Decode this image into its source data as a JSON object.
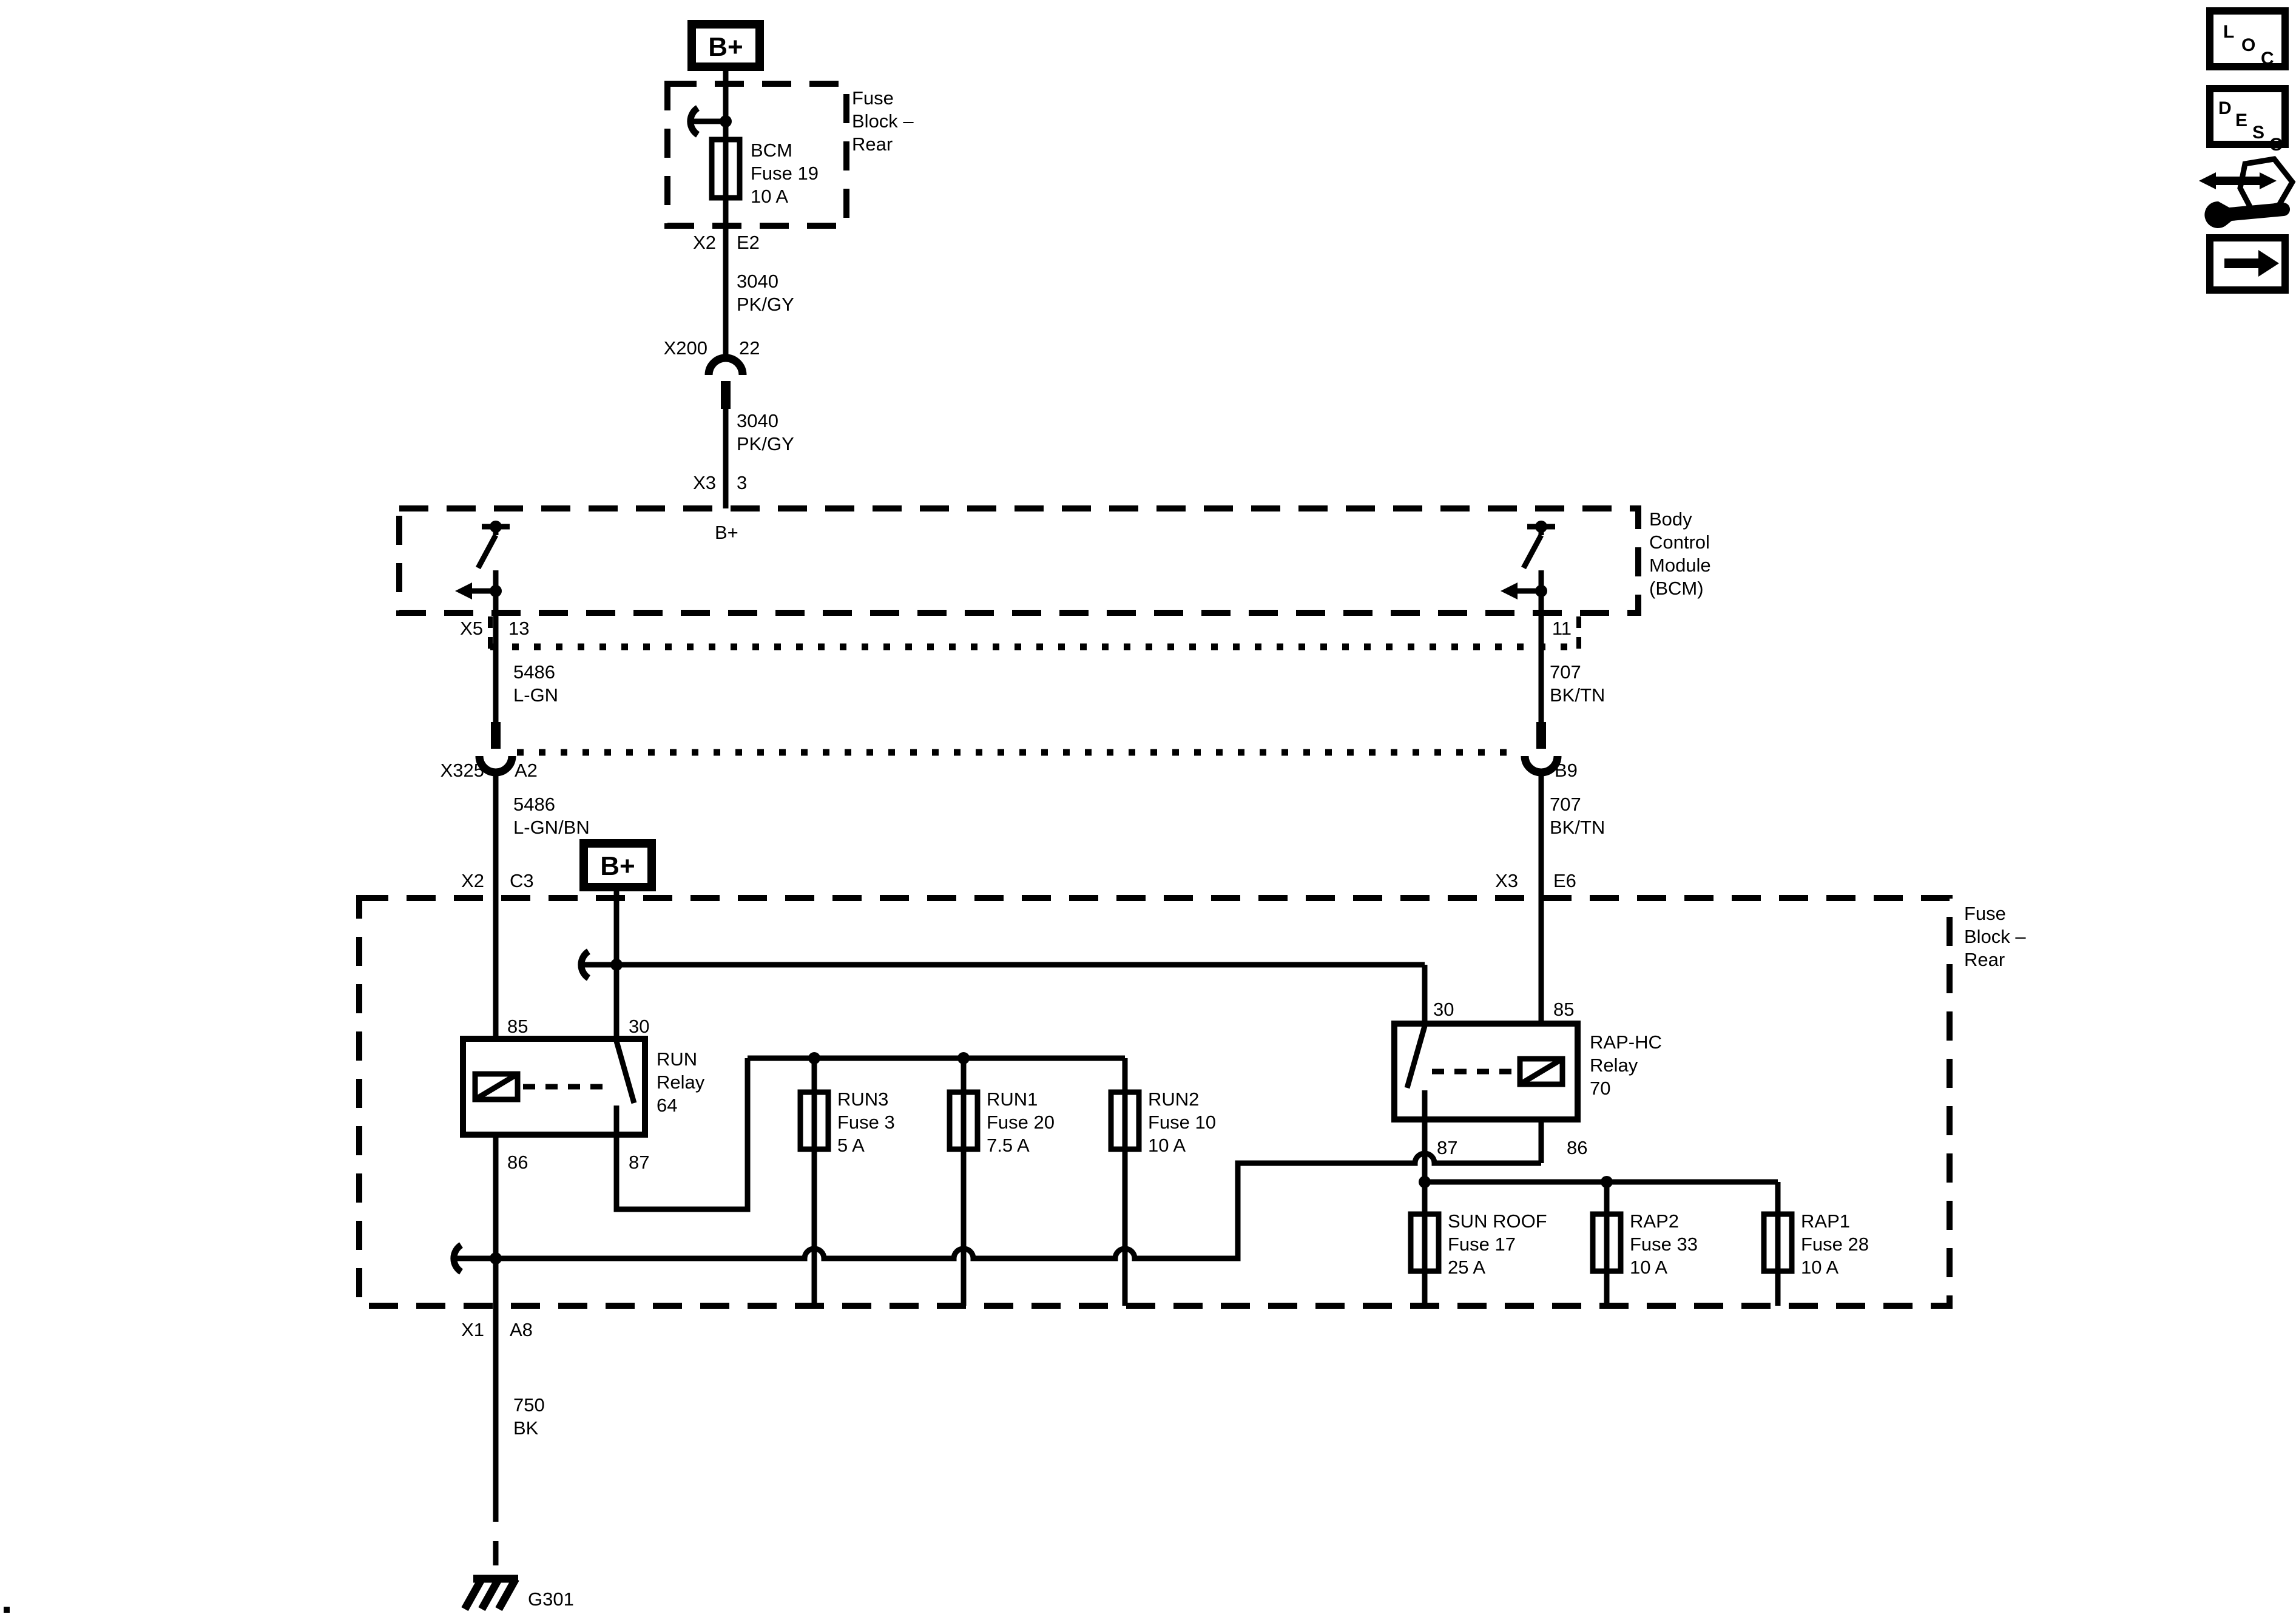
{
  "colors": {
    "ink": "#000000",
    "paper": "#ffffff"
  },
  "top_feed": {
    "battery_symbol": "B+",
    "conn_x2": {
      "name": "X2",
      "pin": "E2"
    },
    "wire_a": {
      "circuit": "3040",
      "color": "PK/GY"
    },
    "splice": {
      "name": "X200",
      "pin": "22"
    },
    "wire_b": {
      "circuit": "3040",
      "color": "PK/GY"
    },
    "conn_x3": {
      "name": "X3",
      "pin": "3"
    }
  },
  "top_fuse_block": {
    "label": [
      "Fuse",
      "Block –",
      "Rear"
    ],
    "fuse": [
      "BCM",
      "Fuse 19",
      "10 A"
    ]
  },
  "bcm": {
    "label": [
      "Body",
      "Control",
      "Module",
      "(BCM)"
    ],
    "b_plus": "B+",
    "left_out": {
      "conn": "X5",
      "pin": "13"
    },
    "right_out": {
      "pin": "11"
    }
  },
  "harness": {
    "left_wire_1": {
      "circuit": "5486",
      "color": "L-GN"
    },
    "right_wire_1": {
      "circuit": "707",
      "color": "BK/TN"
    },
    "conn_row": {
      "name": "X325",
      "left_pin": "A2",
      "right_pin": "B9"
    },
    "left_wire_2": {
      "circuit": "5486",
      "color": "L-GN/BN"
    },
    "right_wire_2": {
      "circuit": "707",
      "color": "BK/TN"
    },
    "left_in": {
      "conn": "X2",
      "pin": "C3"
    },
    "right_in": {
      "conn": "X3",
      "pin": "E6"
    },
    "battery_symbol": "B+"
  },
  "rear_fuse_block": {
    "label": [
      "Fuse",
      "Block –",
      "Rear"
    ],
    "run_relay": {
      "label": [
        "RUN",
        "Relay",
        "64"
      ],
      "pin_tl": "85",
      "pin_tr": "30",
      "pin_bl": "86",
      "pin_br": "87"
    },
    "rap_relay": {
      "label": [
        "RAP-HC",
        "Relay",
        "70"
      ],
      "pin_tl": "30",
      "pin_tr": "85",
      "pin_bl": "87",
      "pin_br": "86"
    },
    "fuses": [
      {
        "lines": [
          "RUN3",
          "Fuse 3",
          "5 A"
        ]
      },
      {
        "lines": [
          "RUN1",
          "Fuse 20",
          "7.5 A"
        ]
      },
      {
        "lines": [
          "RUN2",
          "Fuse 10",
          "10 A"
        ]
      },
      {
        "lines": [
          "SUN ROOF",
          "Fuse 17",
          "25 A"
        ]
      },
      {
        "lines": [
          "RAP2",
          "Fuse 33",
          "10 A"
        ]
      },
      {
        "lines": [
          "RAP1",
          "Fuse 28",
          "10 A"
        ]
      }
    ]
  },
  "ground_path": {
    "out": {
      "conn": "X1",
      "pin": "A8"
    },
    "wire": {
      "circuit": "750",
      "color": "BK"
    },
    "ground": "G301"
  },
  "nav": {
    "loc": [
      "L",
      "O",
      "C"
    ],
    "desc": [
      "D",
      "E",
      "S",
      "C"
    ]
  }
}
